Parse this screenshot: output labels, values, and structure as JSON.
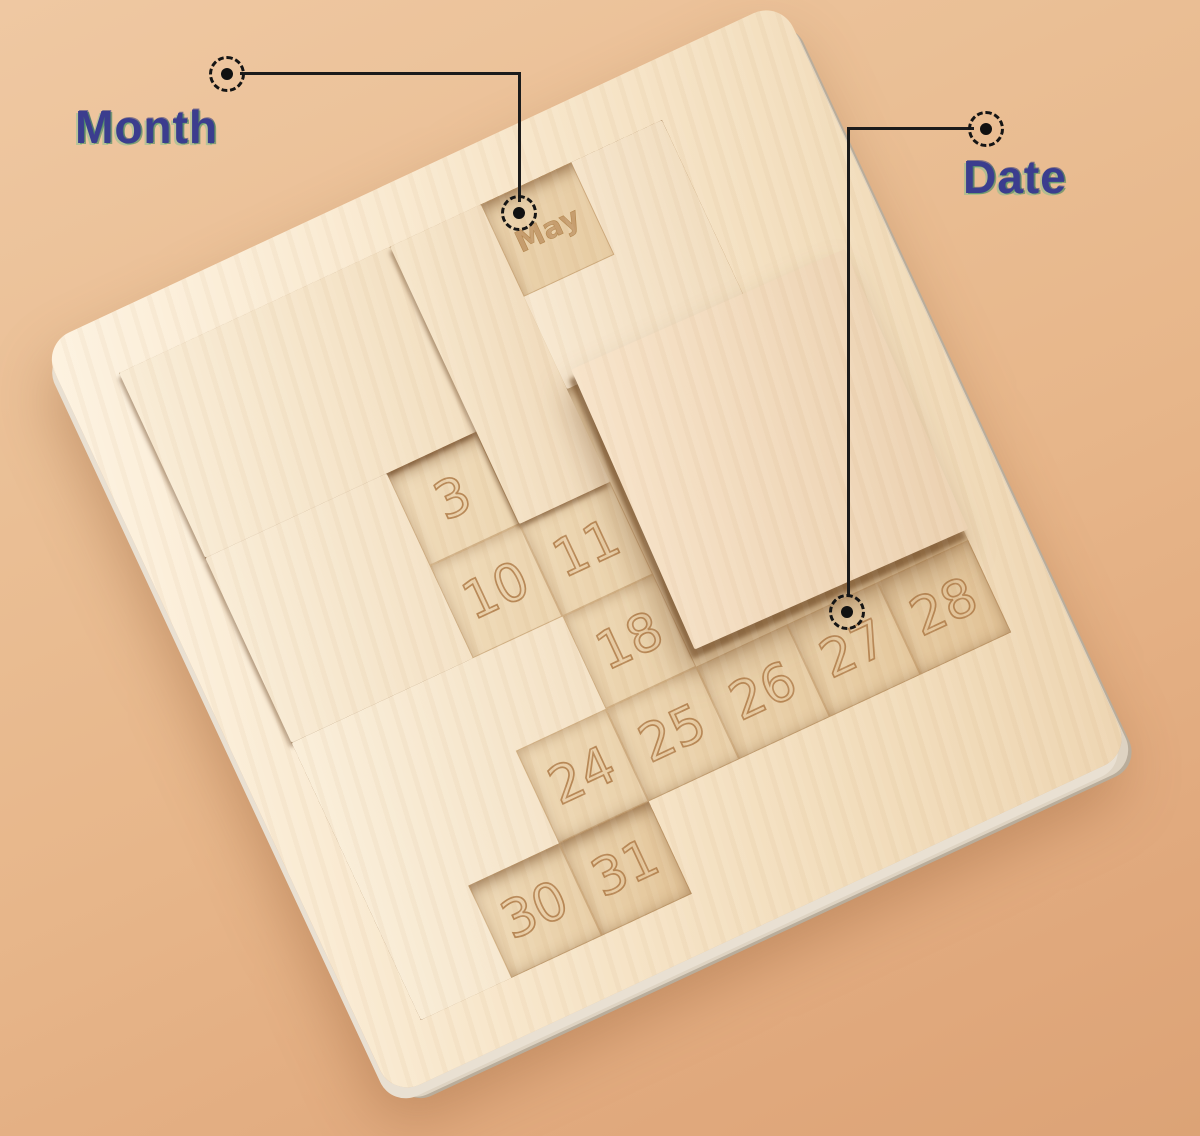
{
  "annotations": {
    "month": {
      "label": "Month",
      "marker_icon": "dashed-target-marker-icon"
    },
    "date": {
      "label": "Date",
      "marker_icon": "dashed-target-marker-icon"
    }
  },
  "board": {
    "month_cell": "May",
    "date_cells": [
      "3",
      "10",
      "11",
      "18",
      "24",
      "25",
      "26",
      "27",
      "28",
      "30",
      "31"
    ]
  },
  "colors": {
    "background_tan": "#e9ba90",
    "board_wood": "#f6e3c6",
    "piece_wood": "#f7e8d0",
    "recess_wood": "#ecd2ad",
    "engraving": "#b07c48",
    "annotation_ink": "#1b1b1b",
    "label_ink": "#3b3d8e"
  }
}
